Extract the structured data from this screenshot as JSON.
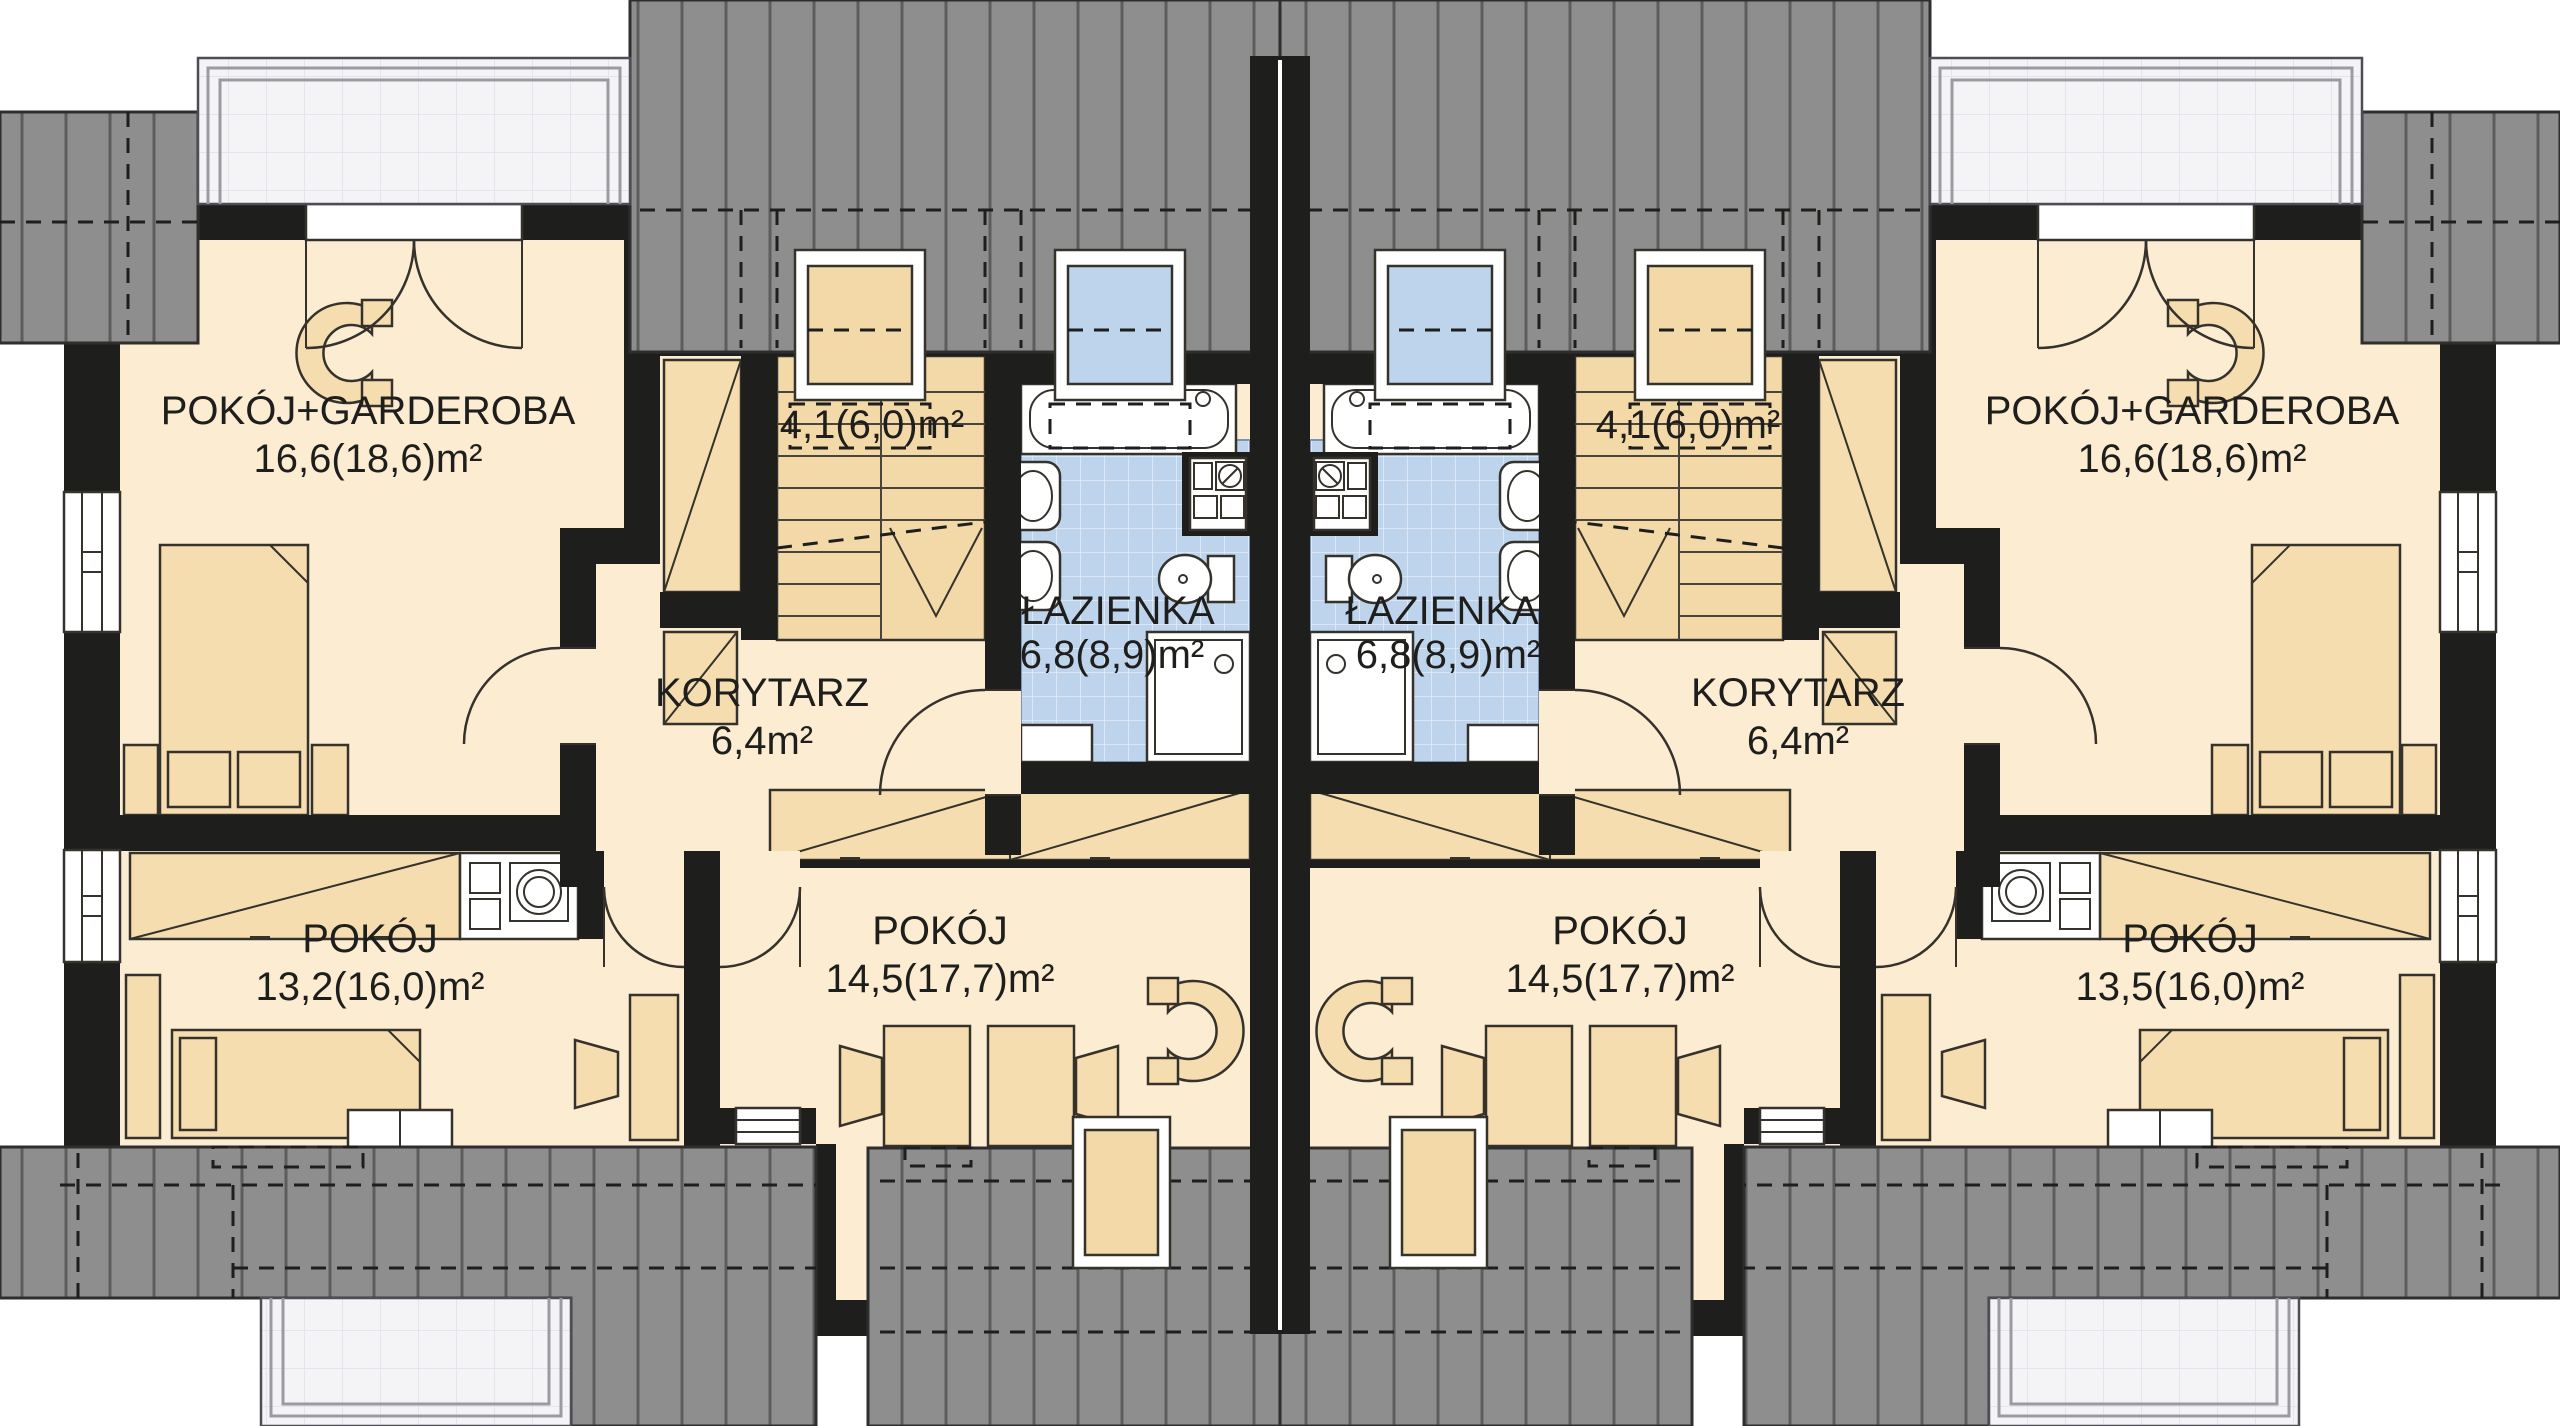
{
  "document": {
    "kind": "architectural-floor-plan",
    "description": "Attic storey plan of a mirrored two-unit (semi-detached) house"
  },
  "colors": {
    "wall": "#1e1e1c",
    "floor": "#fcecd2",
    "furniture": "#f6ddb0",
    "bathroom_tile": "#bed3ec",
    "roof": "#8e8e8e",
    "balcony": "#f4f4f7"
  },
  "units": [
    {
      "side": "left",
      "rooms": [
        {
          "name": "POKÓJ+GARDEROBA",
          "area": "16,6(18,6)m²"
        },
        {
          "name": "",
          "area": "4,1(6,0)m²"
        },
        {
          "name": "KORYTARZ",
          "area": "6,4m²"
        },
        {
          "name": "ŁAZIENKA",
          "area": "6,8(8,9)m²"
        },
        {
          "name": "POKÓJ",
          "area": "13,2(16,0)m²"
        },
        {
          "name": "POKÓJ",
          "area": "14,5(17,7)m²"
        }
      ]
    },
    {
      "side": "right",
      "rooms": [
        {
          "name": "POKÓJ+GARDEROBA",
          "area": "16,6(18,6)m²"
        },
        {
          "name": "",
          "area": "4,1(6,0)m²"
        },
        {
          "name": "KORYTARZ",
          "area": "6,4m²"
        },
        {
          "name": "ŁAZIENKA",
          "area": "6,8(8,9)m²"
        },
        {
          "name": "POKÓJ",
          "area": "13,5(16,0)m²"
        },
        {
          "name": "POKÓJ",
          "area": "14,5(17,7)m²"
        }
      ]
    }
  ]
}
